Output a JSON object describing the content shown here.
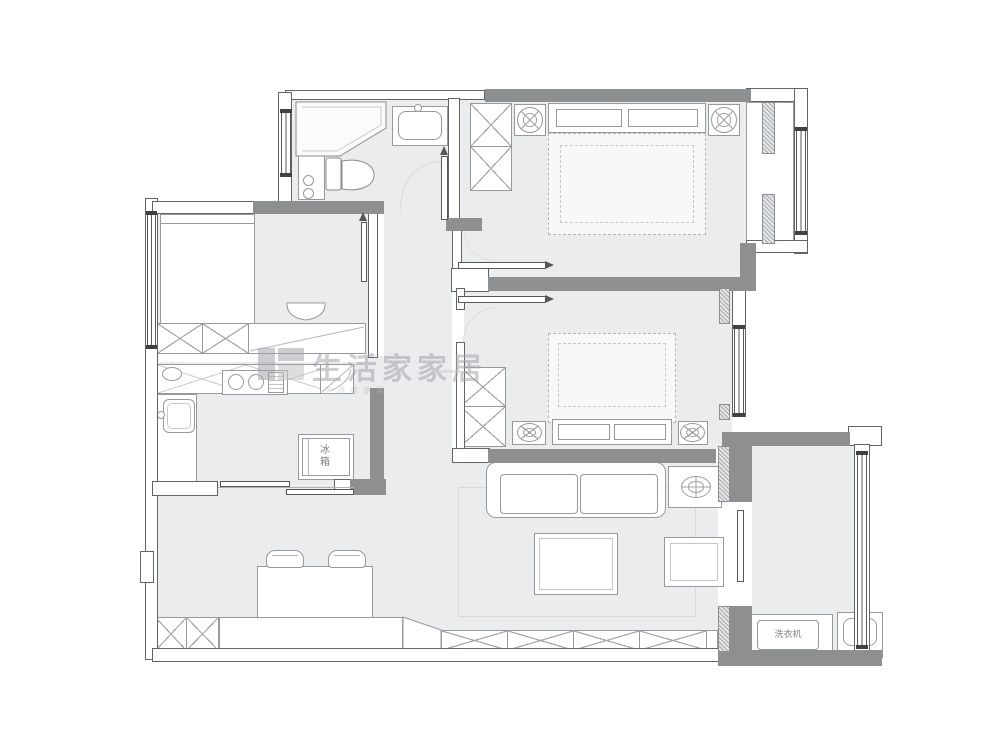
{
  "watermark": {
    "brand": "生活家家居",
    "brand_small": "生活家家居"
  },
  "labels": {
    "fridge": "冰箱",
    "washing_machine": "洗衣机"
  },
  "palette": {
    "wall": "#8e8f91",
    "floor": "#ebecee",
    "fline": "#98999c",
    "winline": "#5a5a5e",
    "wmcolor": "#a4a5ab"
  },
  "semantics": {
    "drawing_type": "apartment floor plan",
    "rooms": [
      "bathroom",
      "bedroom-top-right",
      "bedroom-left",
      "kitchen",
      "bedroom-middle",
      "living-dining-room",
      "balcony"
    ],
    "furniture_icons": [
      "wardrobe-x",
      "double-bed",
      "nightstand-lamp",
      "shower",
      "toilet",
      "vanity-sink",
      "kitchen-counter",
      "cooktop",
      "kitchen-sink",
      "fridge",
      "sofa",
      "coffee-table",
      "side-table-lamp",
      "tv-side-table",
      "dining-table",
      "dining-chair",
      "storage-cabinets",
      "washing-machine",
      "laundry-sink",
      "sliding-door",
      "window"
    ]
  }
}
